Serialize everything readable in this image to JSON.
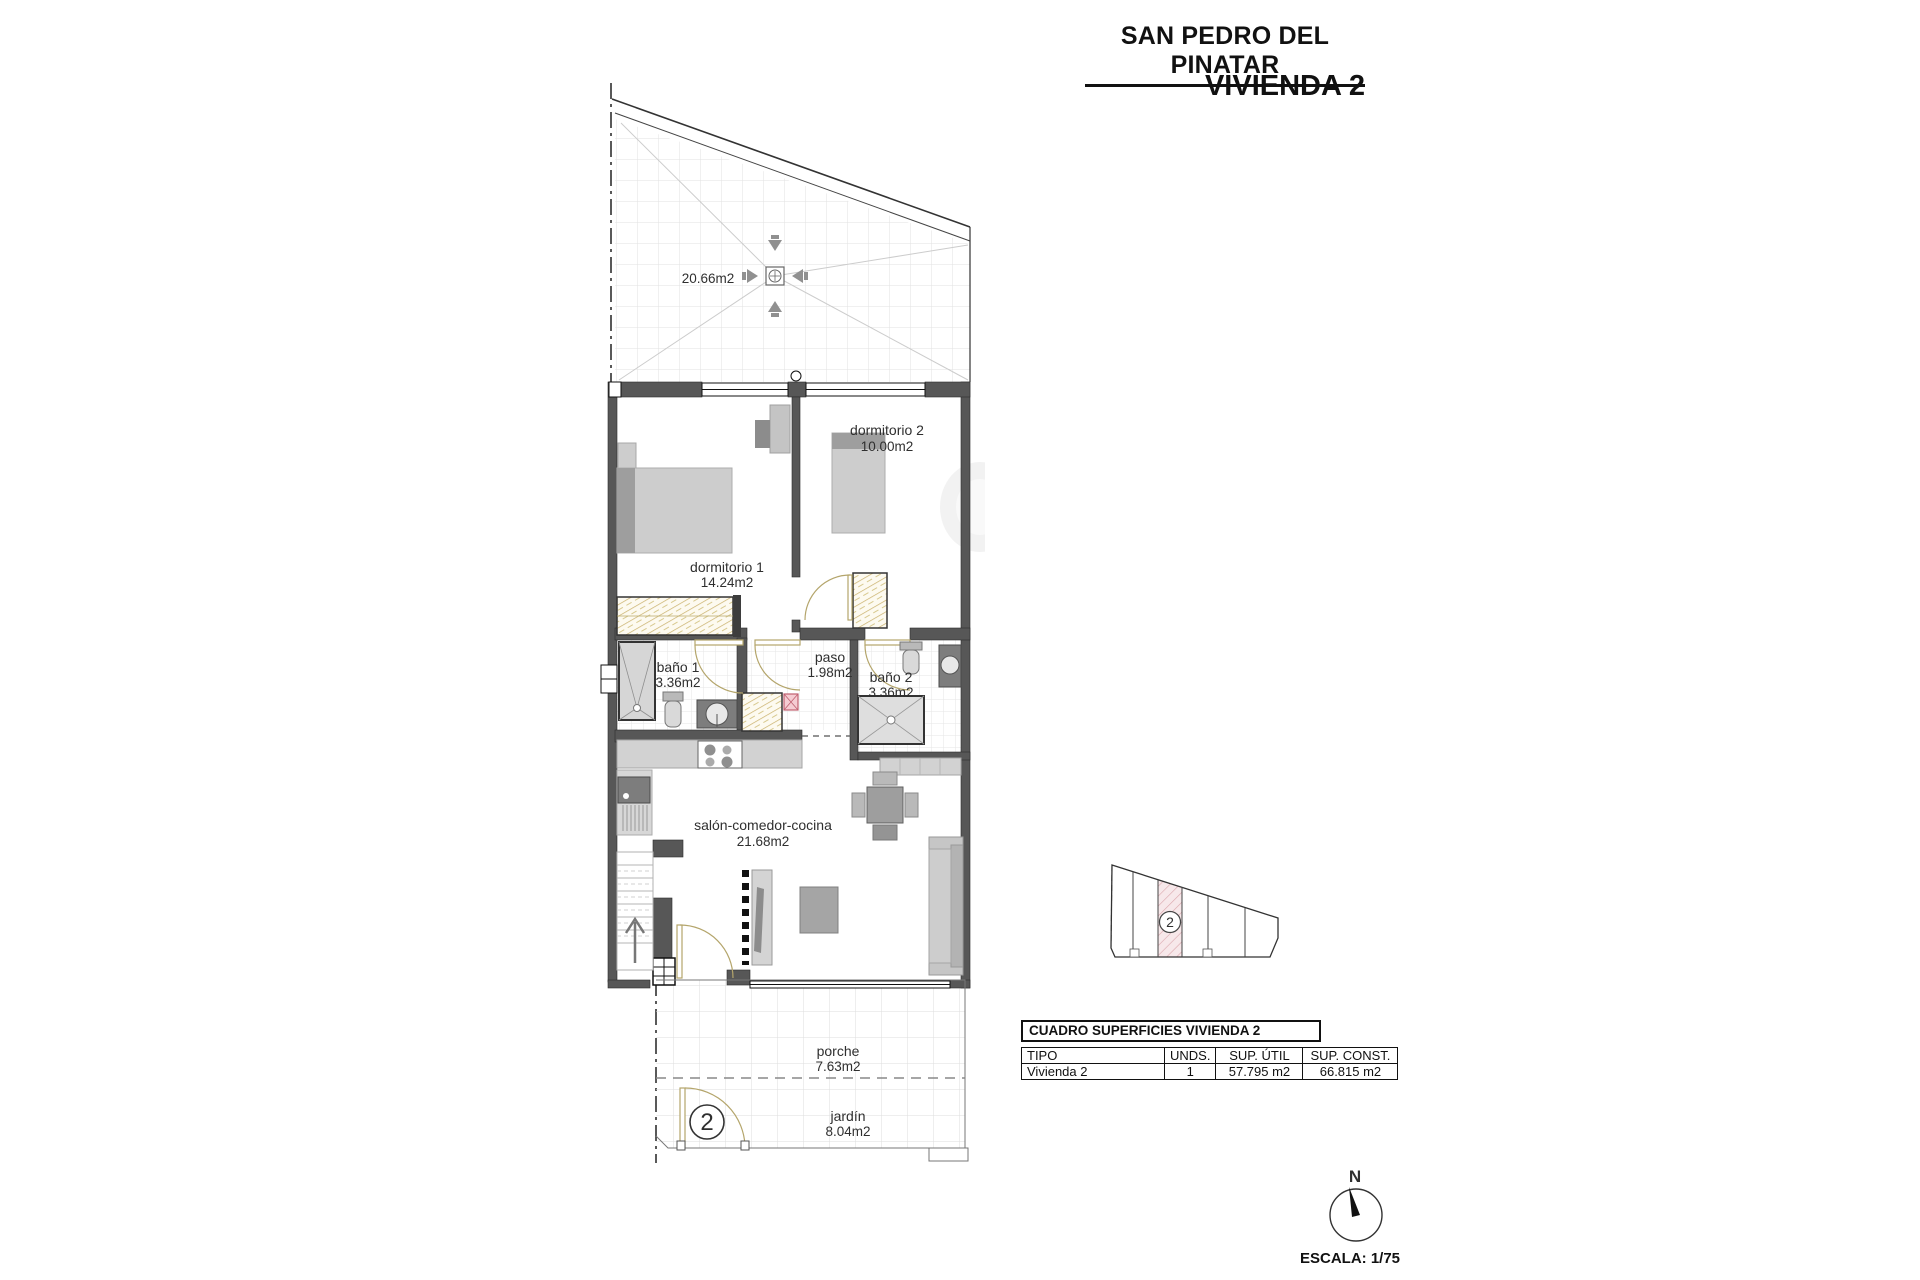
{
  "header": {
    "location_title": "SAN PEDRO DEL PINATAR",
    "unit_title": "VIVIENDA 2"
  },
  "plan": {
    "terrace_area": "20.66m2",
    "rooms": {
      "dormitorio2": {
        "name": "dormitorio 2",
        "area": "10.00m2"
      },
      "dormitorio1": {
        "name": "dormitorio 1",
        "area": "14.24m2"
      },
      "bano1": {
        "name": "baño 1",
        "area": "3.36m2"
      },
      "paso": {
        "name": "paso",
        "area": "1.98m2"
      },
      "bano2": {
        "name": "baño 2",
        "area": "3.36m2"
      },
      "salon": {
        "name": "salón-comedor-cocina",
        "area": "21.68m2"
      },
      "porche": {
        "name": "porche",
        "area": "7.63m2"
      },
      "jardin": {
        "name": "jardín",
        "area": "8.04m2"
      }
    },
    "entrance_marker": "2"
  },
  "key_plan": {
    "highlighted_unit": "2"
  },
  "surface_table": {
    "title": "CUADRO SUPERFICIES VIVIENDA 2",
    "columns": [
      "TIPO",
      "UNDS.",
      "SUP. ÚTIL",
      "SUP. CONST."
    ],
    "rows": [
      {
        "tipo": "Vivienda 2",
        "unds": "1",
        "sup_util": "57.795 m2",
        "sup_const": "66.815 m2"
      }
    ]
  },
  "compass": {
    "north": "N",
    "scale": "ESCALA: 1/75"
  },
  "colors": {
    "wall": "#575757",
    "furniture_light": "#cdcdcd",
    "furniture_dark": "#8c8c8c",
    "closet_hatch": "#c9b06a",
    "door": "#b4a56b",
    "highlight_pink": "#f7e8ea",
    "accent_red": "#c06070"
  }
}
